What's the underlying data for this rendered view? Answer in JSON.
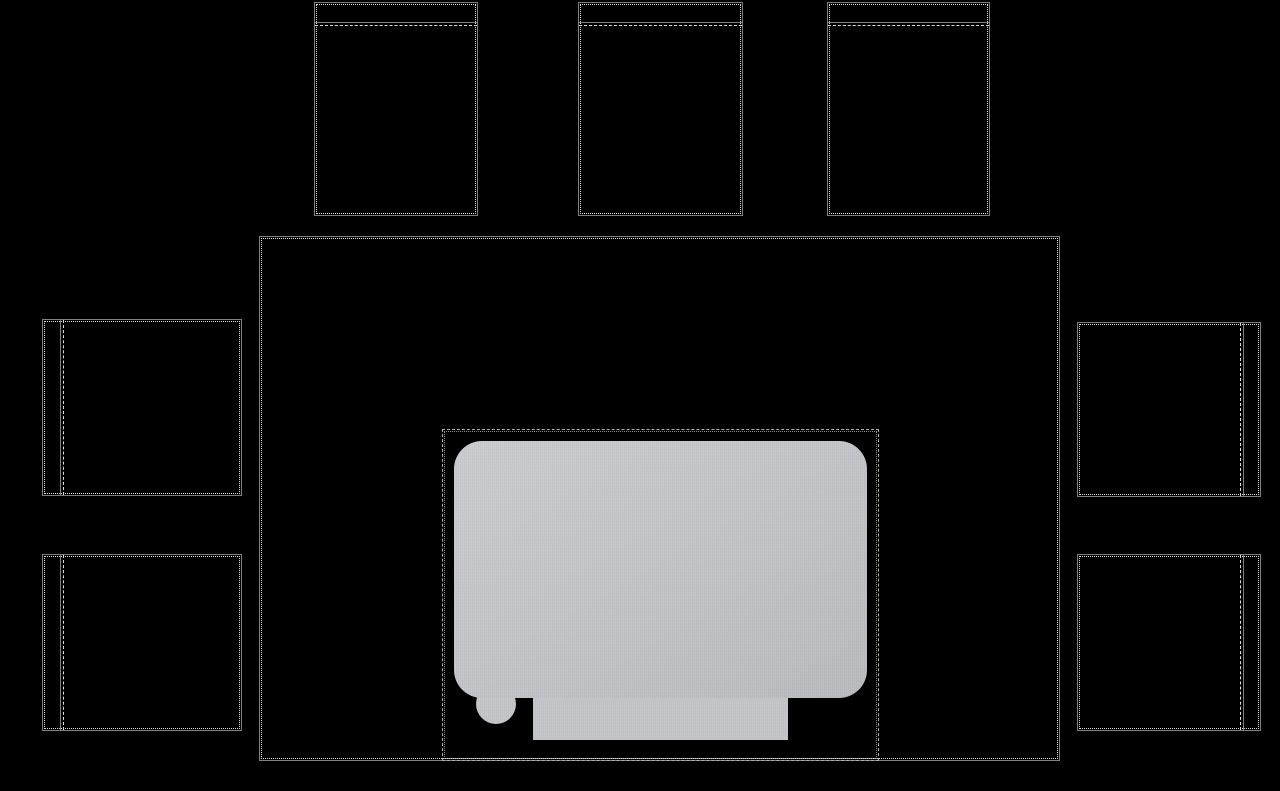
{
  "canvas": {
    "width": 1280,
    "height": 791,
    "background": "#000000"
  },
  "palette": {
    "outline_solid": "#7f7f7f",
    "outline_dots": "#dcdcdc",
    "area_dash": "#b0b0b0",
    "object_fill": "#c5c6ca"
  },
  "scene": {
    "description": "Top-down dark room layout: central table with seven outlined chairs, dashed projection region, light gray object with bottom tab and round foot",
    "table": {
      "x": 259,
      "y": 236,
      "w": 801,
      "h": 525
    },
    "projection_area": {
      "x": 442,
      "y": 429,
      "w": 437,
      "h": 332
    },
    "object": {
      "main": {
        "x": 454,
        "y": 441,
        "w": 413,
        "h": 257,
        "r": 28
      },
      "tab": {
        "x": 533,
        "y": 697,
        "w": 255,
        "h": 43
      },
      "foot": {
        "x": 476,
        "y": 684,
        "w": 40,
        "h": 40,
        "r": 20
      }
    },
    "chairs": {
      "top_1": {
        "seat": {
          "x": 314,
          "y": 2,
          "w": 164,
          "h": 214
        },
        "divider": {
          "x": 315,
          "y": 22,
          "w": 162,
          "h": 4
        }
      },
      "top_2": {
        "seat": {
          "x": 578,
          "y": 2,
          "w": 165,
          "h": 214
        },
        "divider": {
          "x": 579,
          "y": 22,
          "w": 163,
          "h": 4
        }
      },
      "top_3": {
        "seat": {
          "x": 827,
          "y": 2,
          "w": 163,
          "h": 214
        },
        "divider": {
          "x": 828,
          "y": 22,
          "w": 161,
          "h": 4
        }
      },
      "left_1": {
        "seat": {
          "x": 42,
          "y": 319,
          "w": 200,
          "h": 177
        },
        "divider": {
          "x": 60,
          "y": 320,
          "w": 4,
          "h": 175
        }
      },
      "left_2": {
        "seat": {
          "x": 42,
          "y": 554,
          "w": 200,
          "h": 177
        },
        "divider": {
          "x": 60,
          "y": 555,
          "w": 4,
          "h": 175
        }
      },
      "right_1": {
        "seat": {
          "x": 1077,
          "y": 322,
          "w": 184,
          "h": 175
        },
        "divider": {
          "x": 1240,
          "y": 323,
          "w": 4,
          "h": 173
        }
      },
      "right_2": {
        "seat": {
          "x": 1077,
          "y": 554,
          "w": 184,
          "h": 177
        },
        "divider": {
          "x": 1240,
          "y": 555,
          "w": 4,
          "h": 175
        }
      }
    }
  }
}
